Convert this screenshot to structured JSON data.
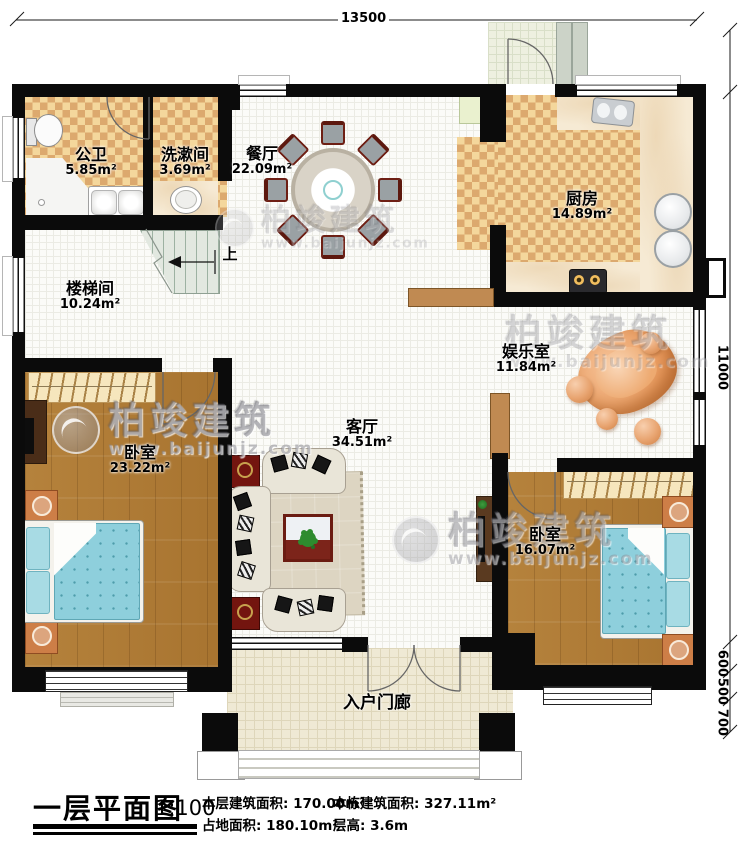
{
  "plan": {
    "dimensions": {
      "width_top": "13500",
      "height_right": "11000",
      "seg_600": "600",
      "seg_500": "500",
      "seg_700": "700"
    },
    "rooms": {
      "gongwei": {
        "name": "公卫",
        "area": "5.85m²"
      },
      "xishujian": {
        "name": "洗漱间",
        "area": "3.69m²"
      },
      "canting": {
        "name": "餐厅",
        "area": "22.09m²"
      },
      "chufang": {
        "name": "厨房",
        "area": "14.89m²"
      },
      "loutijian": {
        "name": "楼梯间",
        "area": "10.24m²"
      },
      "yuleshi": {
        "name": "娱乐室",
        "area": "11.84m²"
      },
      "keting": {
        "name": "客厅",
        "area": "34.51m²"
      },
      "woshi_left": {
        "name": "卧室",
        "area": "23.22m²"
      },
      "woshi_right": {
        "name": "卧室",
        "area": "16.07m²"
      },
      "rumen": {
        "name": "入户门廊"
      }
    },
    "stairs": {
      "up": "上"
    }
  },
  "watermark": {
    "brand": "柏竣建筑",
    "site": "www.baijunjz.com"
  },
  "title_block": {
    "title": "一层平面图",
    "scale": "1:100",
    "floor_area_label": "本层建筑面积:",
    "floor_area_value": "170.00m²",
    "site_area_label": "占地面积:",
    "site_area_value": "180.10m²",
    "total_area_label": "本栋建筑面积:",
    "total_area_value": "327.11m²",
    "height_label": "层高:",
    "height_value": "3.6m"
  },
  "colors": {
    "wall": "#0b0b0b",
    "tile_light": "#f4d79c",
    "tile_dark": "#dca96e",
    "wood": "#b07d38",
    "bed_blue": "#8ecfdc",
    "accent_orange": "#e8a470"
  }
}
